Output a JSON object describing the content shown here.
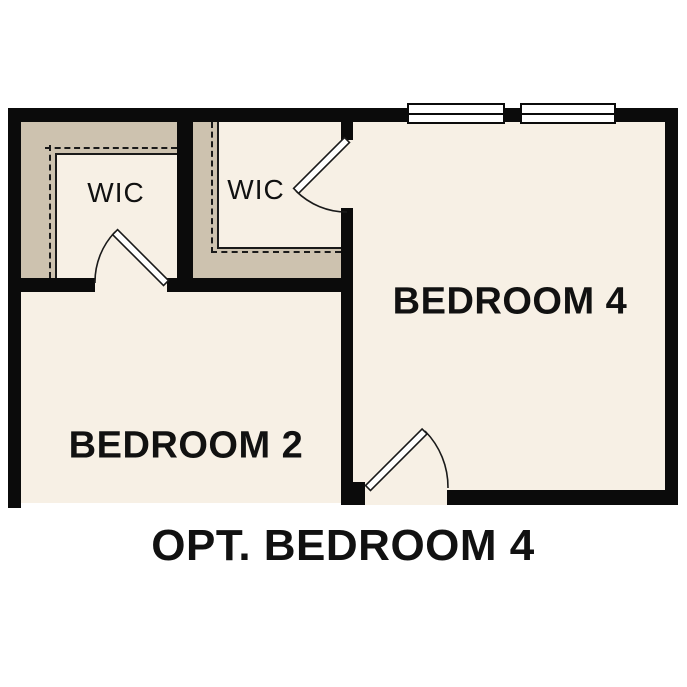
{
  "plan": {
    "caption": "OPT. BEDROOM 4",
    "rooms": {
      "wic_left": {
        "label": "WIC"
      },
      "wic_right": {
        "label": "WIC"
      },
      "bedroom4": {
        "label": "BEDROOM 4"
      },
      "bedroom2": {
        "label": "BEDROOM 2"
      }
    },
    "colors": {
      "wall": "#0b0b0b",
      "floor": "#f7f0e5",
      "shelf": "#cdc2af",
      "line": "#1a1a1a",
      "window": "#ffffff",
      "label": "#111111",
      "page_bg": "#ffffff"
    },
    "symbols": {
      "windows": 2,
      "door_swings": 3
    }
  }
}
